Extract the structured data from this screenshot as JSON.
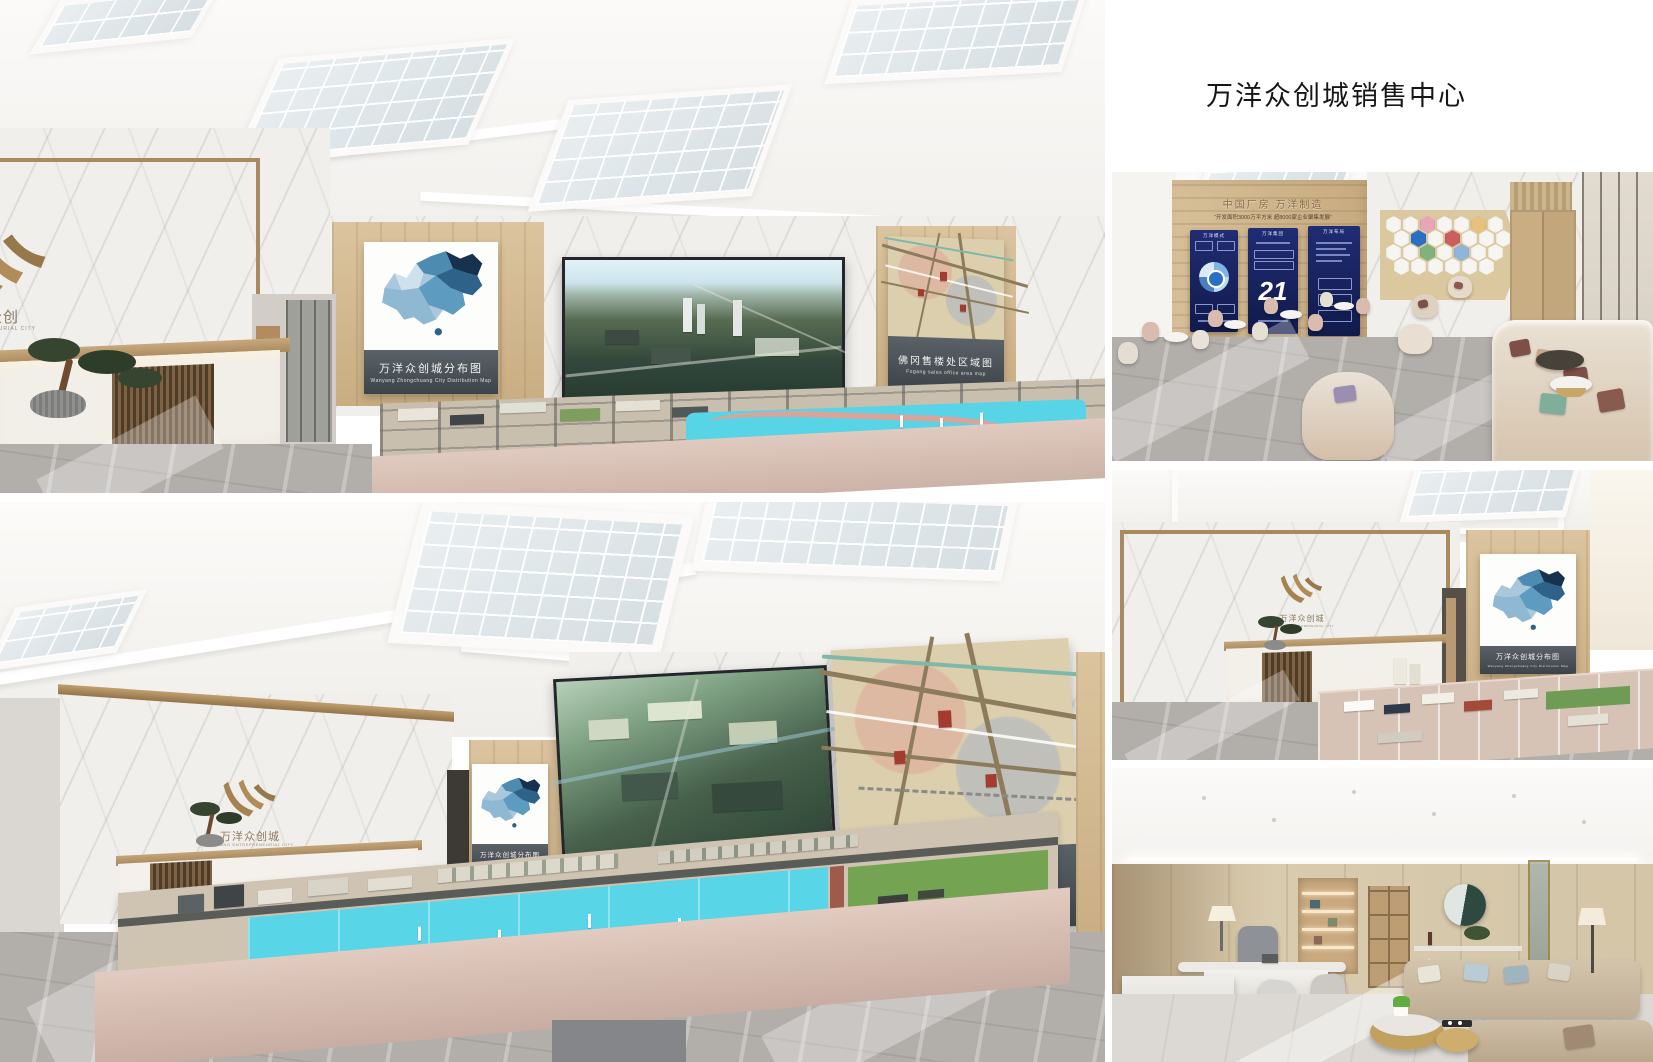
{
  "page": {
    "title": "万洋众创城销售中心",
    "background": "#ffffff"
  },
  "brand": {
    "logo_zh": "万洋众创城",
    "logo_en": "WANYANG ENTREPRENEURIAL CITY"
  },
  "panels": {
    "distribution_map": {
      "zh": "万洋众创城分布图",
      "en": "Wanyang Zhongchuang City Distribution Map"
    },
    "area_map": {
      "zh": "佛冈售楼处区域图",
      "en": "Fogang sales office area map"
    }
  },
  "lounge_wall": {
    "headline": "中国厂房  万洋制造",
    "subline": "“开发面积3000万平方米 超8000家企业聚集发展”",
    "posters": [
      {
        "title": "万洋模式"
      },
      {
        "title": "万洋集团",
        "number": "21"
      },
      {
        "title": "万洋布局"
      }
    ]
  },
  "colors": {
    "accent_bronze": "#a5834f",
    "poster_navy": "#1b2566",
    "caption_slate": "#49525a",
    "model_water": "#57d4e6",
    "map_blue_dark": "#16324f",
    "map_blue_mid": "#4e8bb0"
  }
}
